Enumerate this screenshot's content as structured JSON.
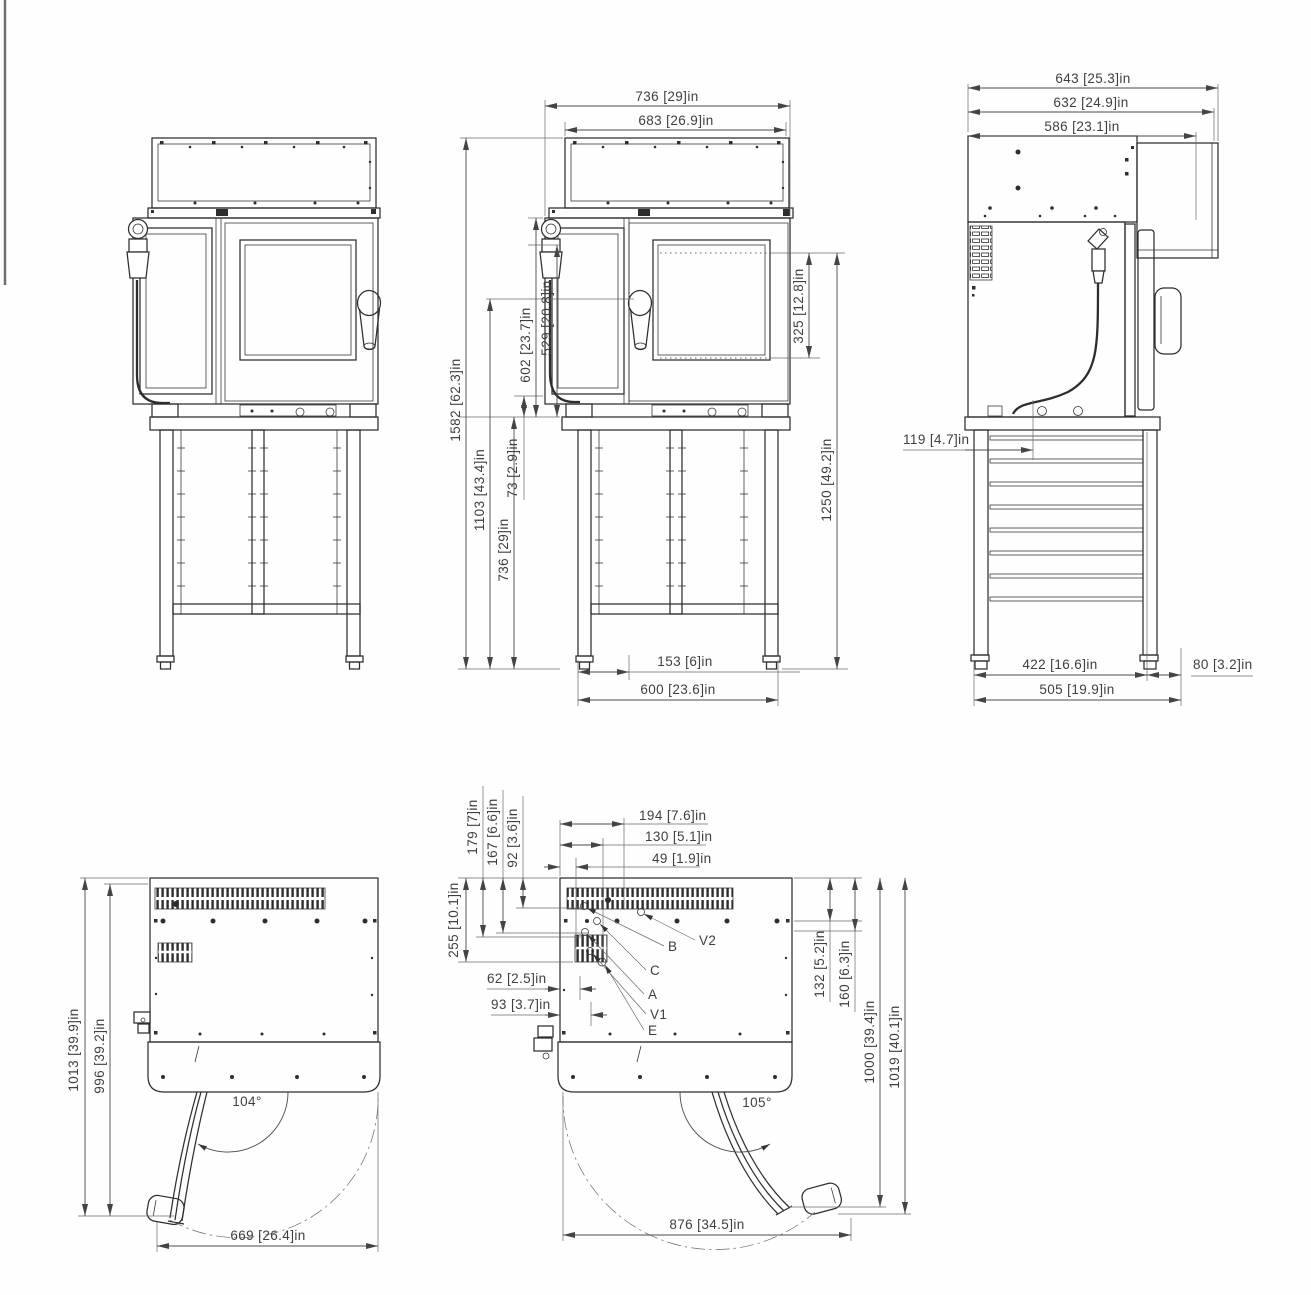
{
  "drawing": {
    "front_view_dims": {
      "width_total": "736 [29]in",
      "width_hood": "683 [26.9]in",
      "height_total": "1582 [62.3]in",
      "height_1103": "1103 [43.4]in",
      "height_stand": "736 [29]in",
      "height_602": "602 [23.7]in",
      "height_529": "529 [20.8]in",
      "gap_73": "73 [2.9]in",
      "rack_325": "325 [12.8]in",
      "height_1250": "1250 [49.2]in",
      "offset_153": "153 [6]in",
      "stand_width": "600 [23.6]in"
    },
    "side_view_dims": {
      "depth_total": "643 [25.3]in",
      "depth_632": "632 [24.9]in",
      "depth_586": "586 [23.1]in",
      "inset_119": "119 [4.7]in",
      "stand_depth_422": "422 [16.6]in",
      "offset_80": "80 [3.2]in",
      "stand_depth_505": "505 [19.9]in"
    },
    "top_view_front_dims": {
      "depth_1013": "1013 [39.9]in",
      "depth_996": "996 [39.2]in",
      "door_angle": "104°",
      "width_669": "669 [26.4]in"
    },
    "top_view_rear_dims": {
      "offset_179": "179 [7]in",
      "offset_167": "167 [6.6]in",
      "offset_92": "92 [3.6]in",
      "offset_194": "194 [7.6]in",
      "offset_130": "130 [5.1]in",
      "offset_49": "49 [1.9]in",
      "offset_255": "255 [10.1]in",
      "offset_62": "62 [2.5]in",
      "offset_93": "93 [3.7]in",
      "offset_132": "132 [5.2]in",
      "offset_160": "160 [6.3]in",
      "depth_1000": "1000 [39.4]in",
      "depth_1019": "1019 [40.1]in",
      "door_angle": "105°",
      "width_876": "876 [34.5]in"
    },
    "connection_labels": {
      "a": "A",
      "b": "B",
      "c": "C",
      "e": "E",
      "v1": "V1",
      "v2": "V2"
    }
  }
}
